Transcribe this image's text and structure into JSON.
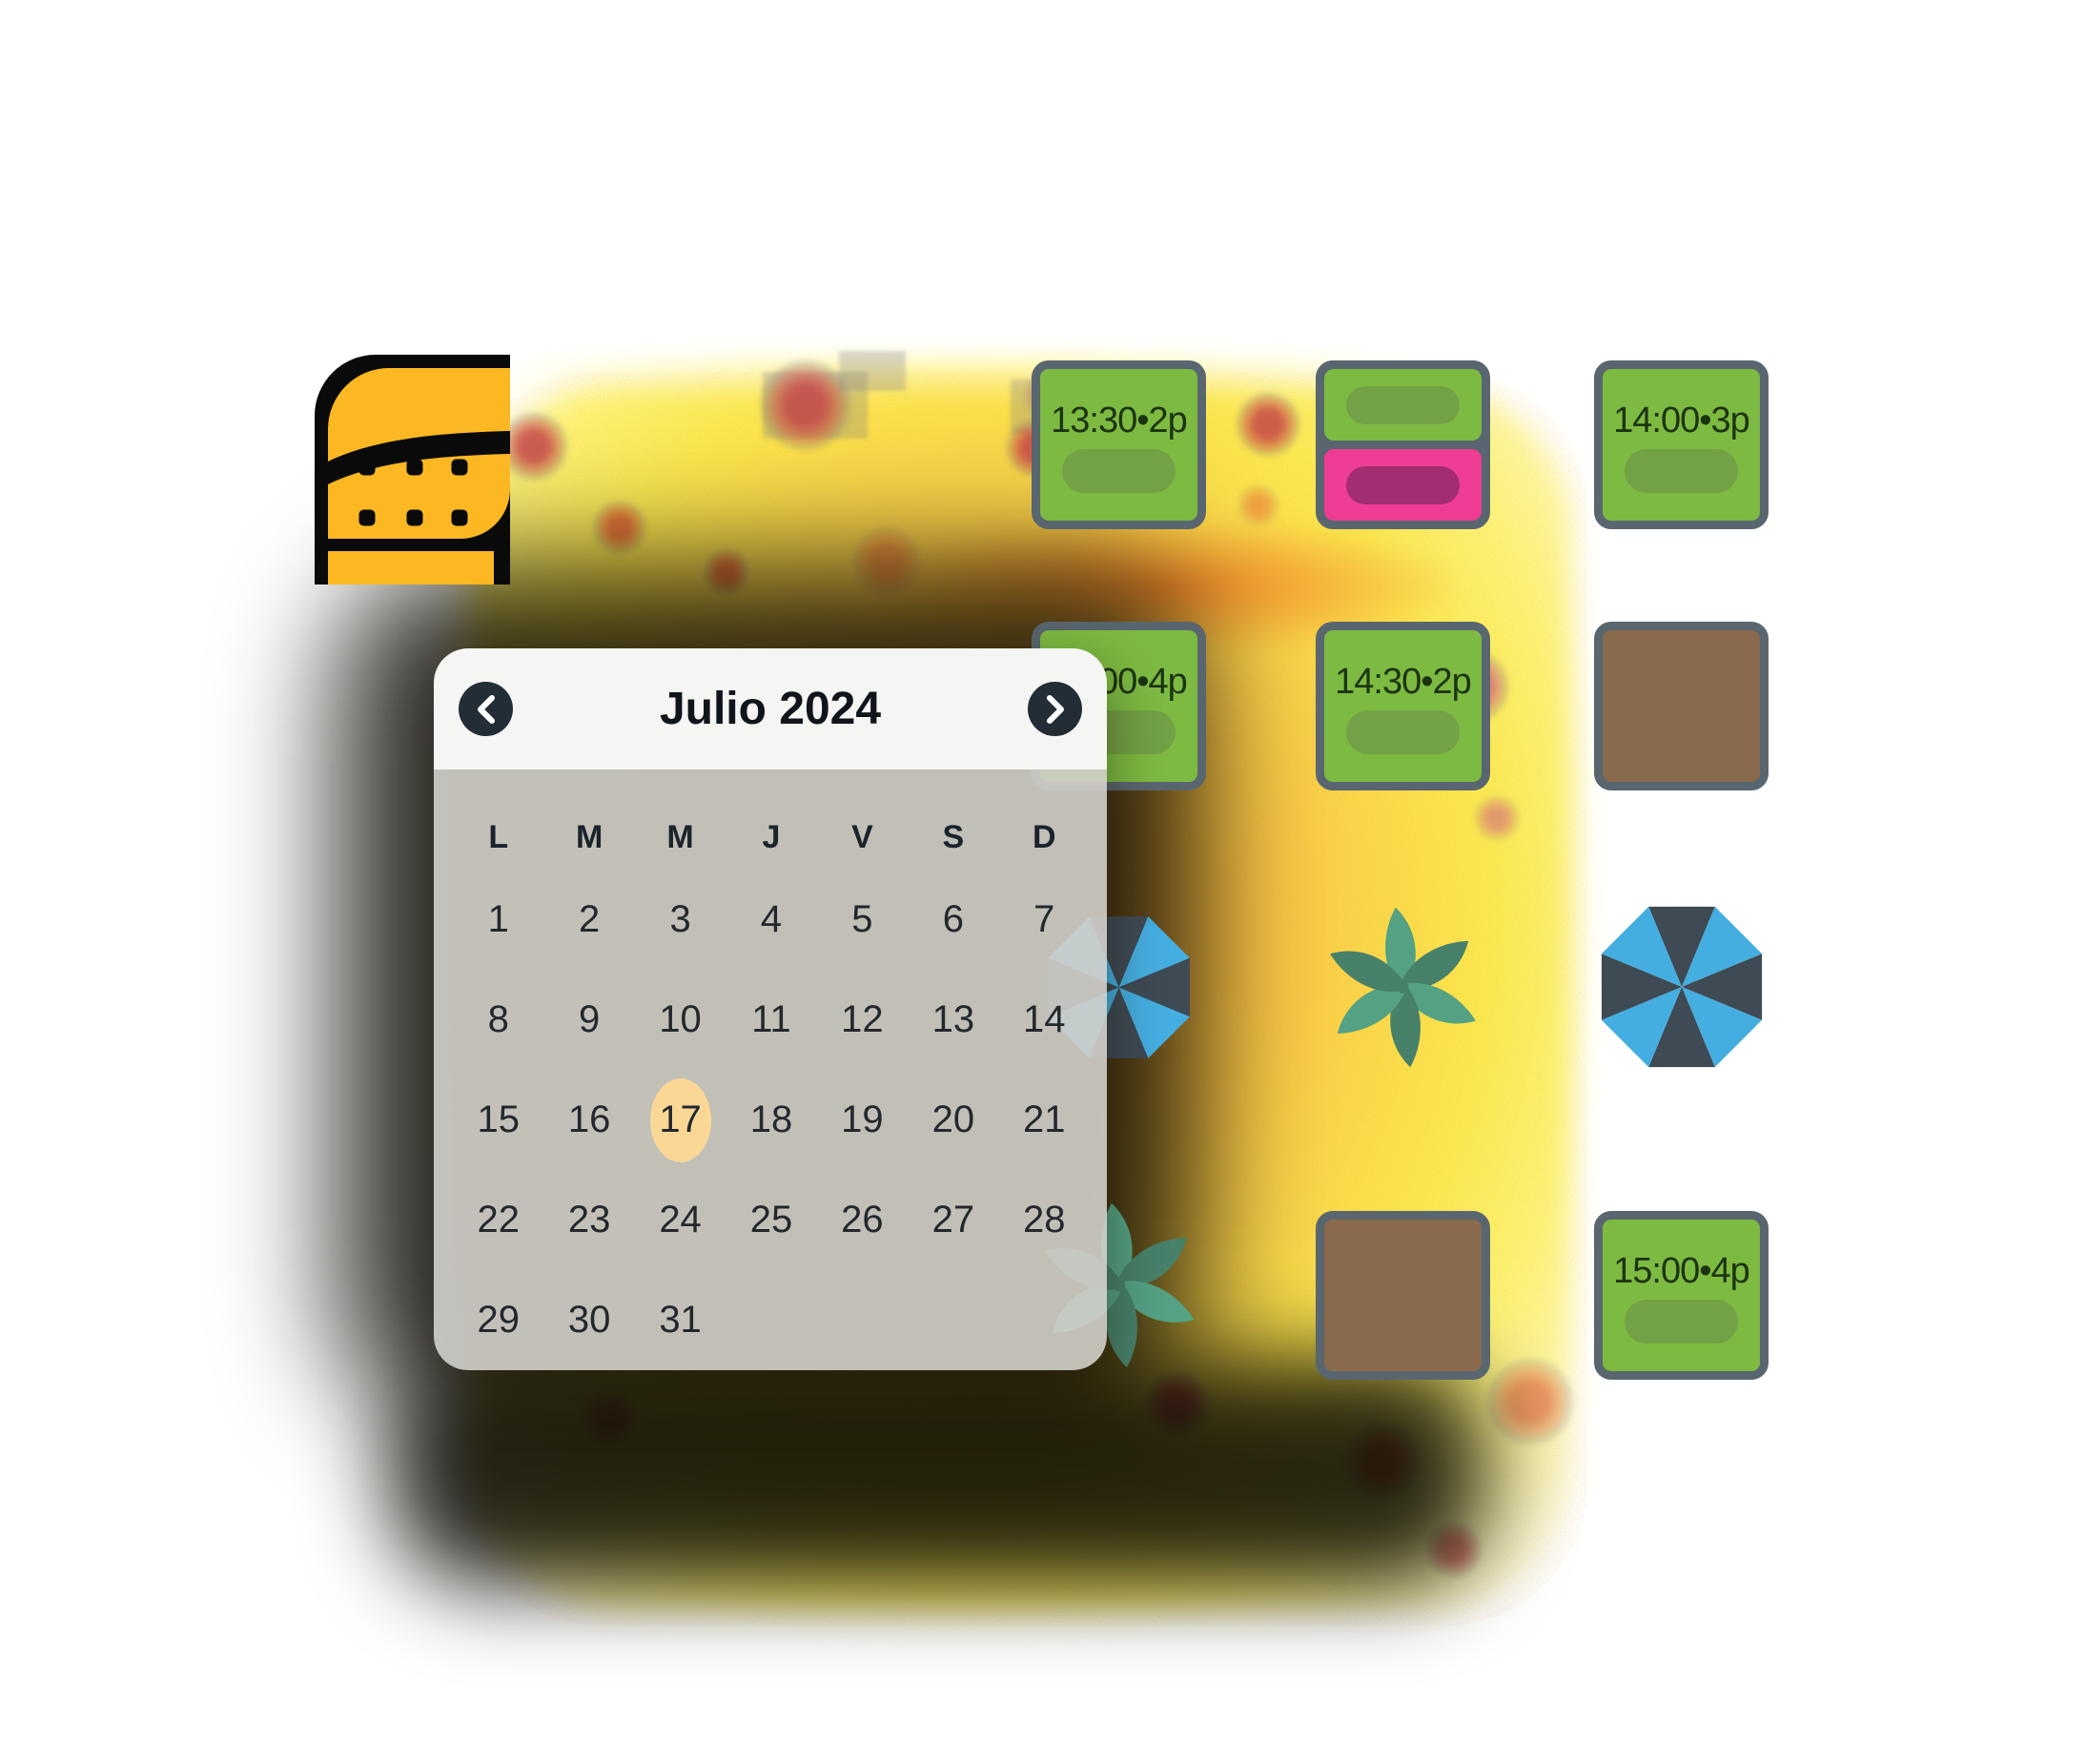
{
  "page": {
    "background_color": "#ffffff"
  },
  "brand_logo": {
    "name": "reservation-book-logo",
    "primary_color": "#fbb822",
    "detail_color": "#0a0a0a",
    "dots_rows": 2,
    "dots_cols": 3
  },
  "calendar": {
    "title": "Julio 2024",
    "prev_icon": "chevron-left",
    "next_icon": "chevron-right",
    "weekday_headers": [
      "L",
      "M",
      "M",
      "J",
      "V",
      "S",
      "D"
    ],
    "weeks": [
      [
        "1",
        "2",
        "3",
        "4",
        "5",
        "6",
        "7"
      ],
      [
        "8",
        "9",
        "10",
        "11",
        "12",
        "13",
        "14"
      ],
      [
        "15",
        "16",
        "17",
        "18",
        "19",
        "20",
        "21"
      ],
      [
        "22",
        "23",
        "24",
        "25",
        "26",
        "27",
        "28"
      ],
      [
        "29",
        "30",
        "31",
        "",
        "",
        "",
        ""
      ]
    ],
    "selected_day": "17",
    "colors": {
      "header_bg": "#f5f6f3",
      "body_bg": "rgba(209,207,202,0.9)",
      "nav_button_bg": "#232d36",
      "nav_icon": "#ffffff",
      "title_text": "#10151b",
      "day_text": "#23282e",
      "selected_bg": "#fad795"
    }
  },
  "floor_plan": {
    "colors": {
      "border": "#5a666f",
      "reserved_bg": "#7dba42",
      "reserved_pill": "#73a146",
      "reserved_text": "#1c330f",
      "alt_bg": "#ee3d92",
      "alt_pill": "#a22d6f",
      "table_bg": "#8a6a4c",
      "umbrella_dark": "#3e4a54",
      "umbrella_blue": "#45aee1",
      "plant_light": "#54a183",
      "plant_dark": "#47816a"
    },
    "items": [
      {
        "row": 1,
        "col": 1,
        "kind": "reservation",
        "label": "13:30•2p"
      },
      {
        "row": 1,
        "col": 2,
        "kind": "split-reservation",
        "segments": [
          "green",
          "pink"
        ]
      },
      {
        "row": 1,
        "col": 3,
        "kind": "reservation",
        "label": "14:00•3p"
      },
      {
        "row": 2,
        "col": 1,
        "kind": "reservation",
        "label": "14:00•4p",
        "partially_hidden": true
      },
      {
        "row": 2,
        "col": 2,
        "kind": "reservation",
        "label": "14:30•2p"
      },
      {
        "row": 2,
        "col": 3,
        "kind": "table"
      },
      {
        "row": 3,
        "col": 1,
        "kind": "umbrella"
      },
      {
        "row": 3,
        "col": 2,
        "kind": "plant"
      },
      {
        "row": 3,
        "col": 3,
        "kind": "umbrella"
      },
      {
        "row": 4,
        "col": 1,
        "kind": "plant"
      },
      {
        "row": 4,
        "col": 2,
        "kind": "table"
      },
      {
        "row": 4,
        "col": 3,
        "kind": "reservation",
        "label": "15:00•4p"
      }
    ]
  },
  "background_glow": {
    "core_colors": [
      "#f1a13c",
      "#fad247",
      "#fbe94d",
      "#fcf478"
    ],
    "speckle_colors": [
      "#c23948",
      "#e05a35",
      "#c94e86"
    ]
  }
}
